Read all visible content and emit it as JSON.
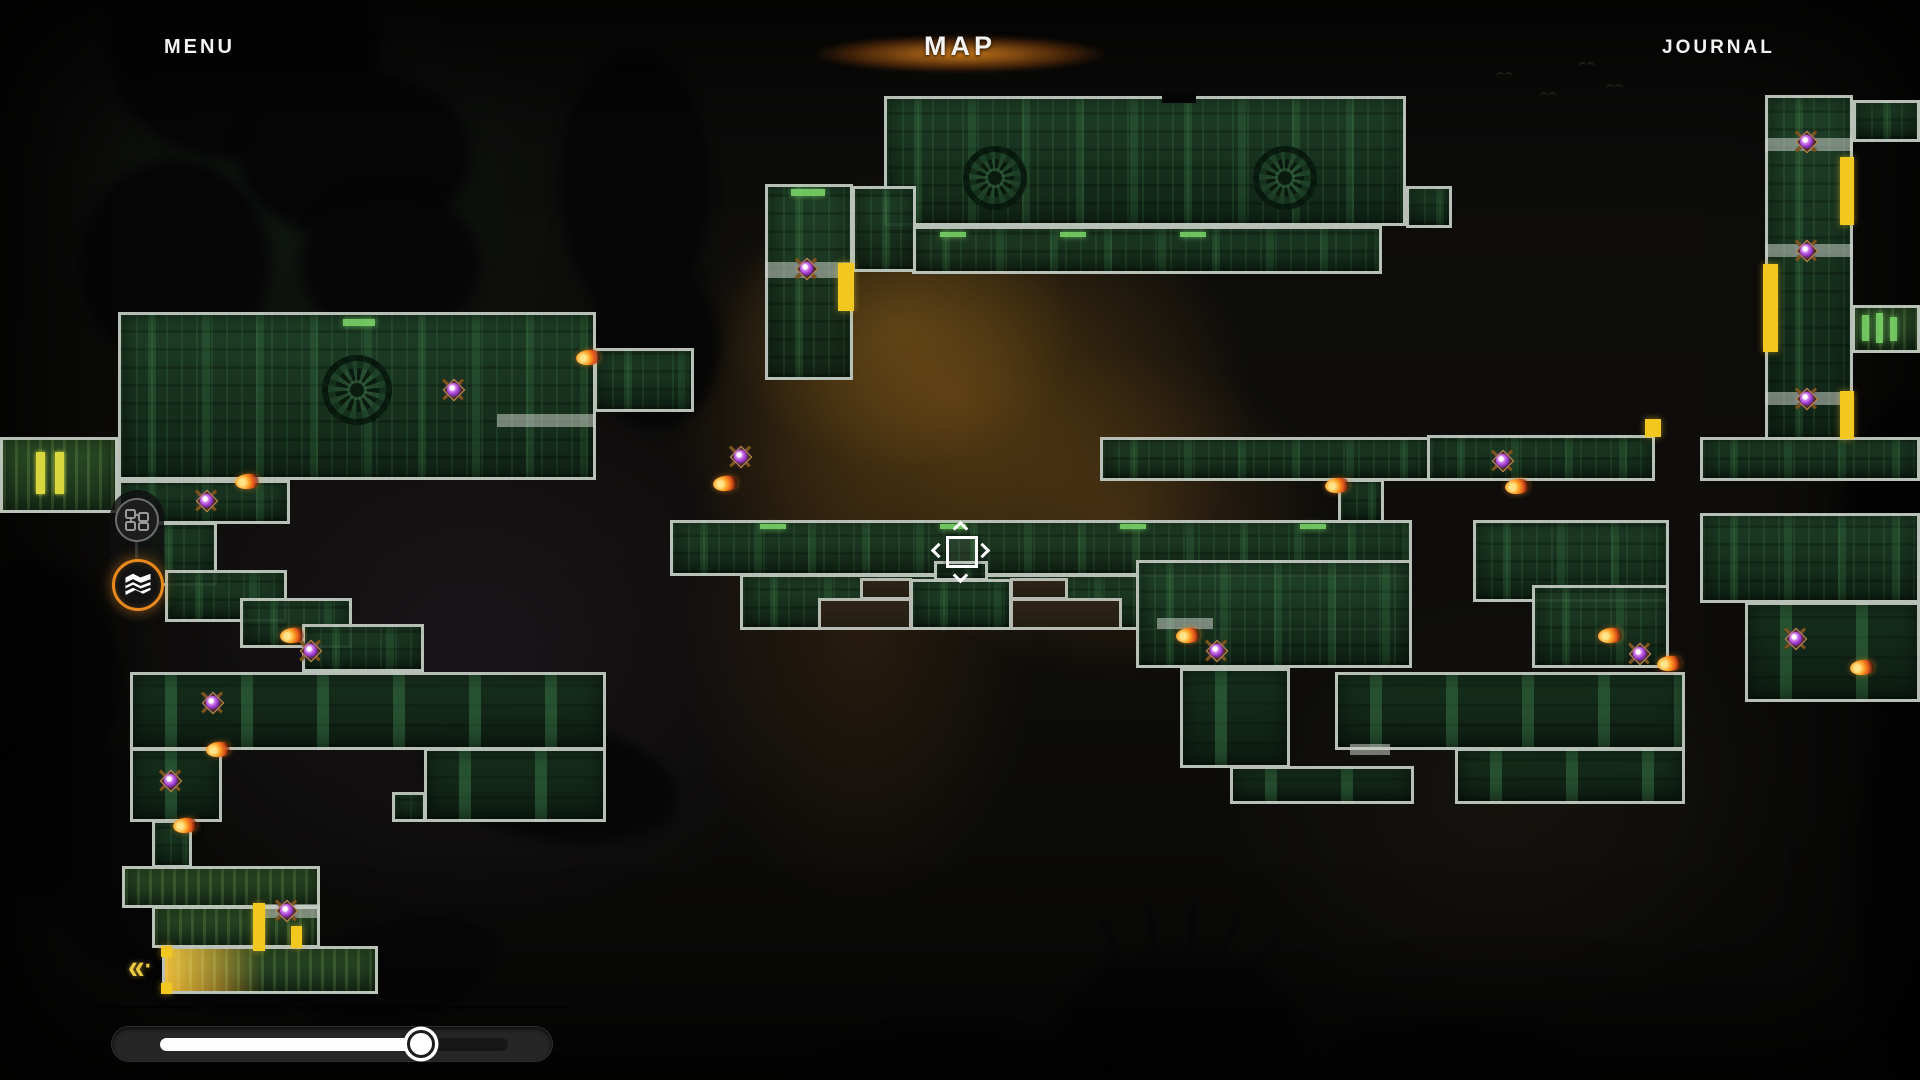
{
  "header": {
    "menu": "MENU",
    "title": "MAP",
    "journal": "JOURNAL"
  },
  "colors": {
    "room_fill": "#1b3a26",
    "room_border": "#c6ccc4",
    "door_yellow": "#f2c71f",
    "accent_green": "#7fdd6b",
    "accent_orange": "#e8891d",
    "marker_purple": "#a84fd6",
    "band_gray": "#cbd0c8",
    "highlight_orange": "#f4b428",
    "slider_fill": "#fdfdfd"
  },
  "sidebar": {
    "tabs": [
      {
        "name": "rooms-view",
        "icon": "node-graph-icon",
        "active": false
      },
      {
        "name": "map-view",
        "icon": "map-icon",
        "active": true
      }
    ]
  },
  "zoom_slider": {
    "value": 0.75
  },
  "map": {
    "player": {
      "x": 960,
      "y": 550,
      "icon": "player-location-marker"
    },
    "fast_travel": {
      "x": 128,
      "y": 956,
      "glyph": "«"
    },
    "rooms": [
      {
        "rect": [
          884,
          96,
          522,
          130
        ],
        "tex": "plain"
      },
      {
        "rect": [
          912,
          226,
          470,
          48
        ],
        "tex": "plain"
      },
      {
        "rect": [
          765,
          184,
          88,
          196
        ],
        "tex": "plain"
      },
      {
        "rect": [
          852,
          186,
          64,
          86
        ],
        "tex": "plain"
      },
      {
        "rect": [
          1406,
          186,
          46,
          42
        ],
        "tex": "plain"
      },
      {
        "rect": [
          1765,
          95,
          88,
          345
        ],
        "tex": "plain"
      },
      {
        "rect": [
          1853,
          100,
          67,
          42
        ],
        "tex": "plain"
      },
      {
        "rect": [
          1852,
          305,
          68,
          48
        ],
        "tex": "bright"
      },
      {
        "rect": [
          118,
          312,
          478,
          168
        ],
        "tex": "plain"
      },
      {
        "rect": [
          594,
          348,
          100,
          64
        ],
        "tex": "plain"
      },
      {
        "rect": [
          0,
          437,
          118,
          76
        ],
        "tex": "bright"
      },
      {
        "rect": [
          118,
          480,
          172,
          44
        ],
        "tex": "plain"
      },
      {
        "rect": [
          135,
          522,
          82,
          64
        ],
        "tex": "plain"
      },
      {
        "rect": [
          165,
          570,
          122,
          52
        ],
        "tex": "plain"
      },
      {
        "rect": [
          240,
          598,
          112,
          50
        ],
        "tex": "plain"
      },
      {
        "rect": [
          302,
          624,
          122,
          48
        ],
        "tex": "plain"
      },
      {
        "rect": [
          130,
          672,
          476,
          78
        ],
        "tex": "pillars"
      },
      {
        "rect": [
          130,
          748,
          92,
          74
        ],
        "tex": "pillars"
      },
      {
        "rect": [
          424,
          748,
          182,
          74
        ],
        "tex": "pillars"
      },
      {
        "rect": [
          392,
          792,
          34,
          30
        ],
        "tex": "plain"
      },
      {
        "rect": [
          152,
          820,
          40,
          48
        ],
        "tex": "plain"
      },
      {
        "rect": [
          122,
          866,
          198,
          42
        ],
        "tex": "bright"
      },
      {
        "rect": [
          152,
          906,
          168,
          42
        ],
        "tex": "bright"
      },
      {
        "rect": [
          162,
          946,
          216,
          48
        ],
        "tex": "bright"
      },
      {
        "rect": [
          670,
          520,
          742,
          56
        ],
        "tex": "plain"
      },
      {
        "rect": [
          740,
          574,
          672,
          56
        ],
        "tex": "plain"
      },
      {
        "rect": [
          1136,
          560,
          276,
          108
        ],
        "tex": "plain"
      },
      {
        "rect": [
          1100,
          437,
          334,
          44
        ],
        "tex": "plain"
      },
      {
        "rect": [
          1338,
          479,
          46,
          44
        ],
        "tex": "plain"
      },
      {
        "rect": [
          1427,
          435,
          228,
          46
        ],
        "tex": "plain"
      },
      {
        "rect": [
          1700,
          437,
          220,
          44
        ],
        "tex": "plain"
      },
      {
        "rect": [
          1473,
          520,
          196,
          82
        ],
        "tex": "plain"
      },
      {
        "rect": [
          1532,
          585,
          137,
          83
        ],
        "tex": "plain"
      },
      {
        "rect": [
          1700,
          513,
          220,
          90
        ],
        "tex": "plain"
      },
      {
        "rect": [
          1745,
          602,
          175,
          100
        ],
        "tex": "pillars"
      },
      {
        "rect": [
          1180,
          668,
          110,
          100
        ],
        "tex": "pillars"
      },
      {
        "rect": [
          1335,
          672,
          350,
          78
        ],
        "tex": "pillars"
      },
      {
        "rect": [
          1230,
          766,
          184,
          38
        ],
        "tex": "pillars"
      },
      {
        "rect": [
          1455,
          748,
          230,
          56
        ],
        "tex": "pillars"
      },
      {
        "rect": [
          934,
          561,
          54,
          20
        ],
        "tex": "plain"
      },
      {
        "rect": [
          910,
          579,
          102,
          51
        ],
        "tex": "plain"
      }
    ],
    "cutouts": [
      [
        818,
        598,
        94,
        32
      ],
      [
        860,
        578,
        52,
        22
      ],
      [
        1010,
        578,
        58,
        22
      ],
      [
        1010,
        598,
        112,
        32
      ]
    ],
    "gears": [
      [
        995,
        178,
        32
      ],
      [
        1285,
        178,
        32
      ],
      [
        357,
        390,
        35
      ]
    ],
    "bands": [
      [
        765,
        262,
        88,
        16
      ],
      [
        1765,
        138,
        88,
        13
      ],
      [
        1765,
        244,
        88,
        13
      ],
      [
        1765,
        392,
        88,
        13
      ],
      [
        497,
        414,
        98,
        13
      ],
      [
        262,
        904,
        58,
        14
      ],
      [
        1350,
        744,
        40,
        11
      ],
      [
        1157,
        618,
        56,
        11
      ]
    ],
    "doors": [
      {
        "rect": [
          838,
          263,
          16,
          48
        ]
      },
      {
        "rect": [
          1840,
          157,
          14,
          68
        ]
      },
      {
        "rect": [
          1763,
          264,
          15,
          88
        ]
      },
      {
        "rect": [
          1840,
          391,
          14,
          48
        ]
      },
      {
        "rect": [
          1645,
          419,
          16,
          18
        ]
      },
      {
        "rect": [
          253,
          903,
          12,
          48
        ]
      },
      {
        "rect": [
          291,
          926,
          11,
          22
        ]
      },
      {
        "rect": [
          161,
          946,
          11,
          11
        ]
      },
      {
        "rect": [
          161,
          983,
          11,
          11
        ]
      },
      {
        "rect": [
          36,
          452,
          9,
          42
        ],
        "color": "#d8d83e"
      },
      {
        "rect": [
          55,
          452,
          9,
          42
        ],
        "color": "#d8d83e"
      }
    ],
    "accents": [
      [
        791,
        189,
        34,
        7
      ],
      [
        343,
        319,
        32,
        7
      ],
      [
        1862,
        315,
        7,
        26
      ],
      [
        1876,
        313,
        7,
        30
      ],
      [
        1890,
        317,
        7,
        24
      ],
      [
        760,
        524,
        26,
        5
      ],
      [
        940,
        524,
        26,
        5
      ],
      [
        1120,
        524,
        26,
        5
      ],
      [
        1300,
        524,
        26,
        5
      ],
      [
        940,
        232,
        26,
        5
      ],
      [
        1060,
        232,
        26,
        5
      ],
      [
        1180,
        232,
        26,
        5
      ]
    ],
    "notches": [
      [
        1162,
        92,
        34,
        11
      ],
      [
        392,
        300,
        32,
        11
      ]
    ],
    "highlight": [
      165,
      949,
      100,
      42
    ],
    "enemy_markers": [
      [
        806,
        268
      ],
      [
        453,
        389
      ],
      [
        740,
        456
      ],
      [
        206,
        500
      ],
      [
        310,
        650
      ],
      [
        212,
        702
      ],
      [
        170,
        780
      ],
      [
        286,
        910
      ],
      [
        1216,
        650
      ],
      [
        1502,
        460
      ],
      [
        1639,
        653
      ],
      [
        1795,
        638
      ],
      [
        1806,
        141
      ],
      [
        1806,
        250
      ],
      [
        1806,
        398
      ]
    ],
    "flame_markers": [
      [
        588,
        358
      ],
      [
        725,
        484
      ],
      [
        247,
        482
      ],
      [
        292,
        636
      ],
      [
        218,
        750
      ],
      [
        185,
        826
      ],
      [
        1337,
        486
      ],
      [
        1517,
        487
      ],
      [
        1188,
        636
      ],
      [
        1610,
        636
      ],
      [
        1669,
        664
      ],
      [
        1862,
        668
      ]
    ],
    "birds": [
      [
        1496,
        72
      ],
      [
        1540,
        92
      ],
      [
        1578,
        62
      ],
      [
        1606,
        84
      ]
    ]
  }
}
